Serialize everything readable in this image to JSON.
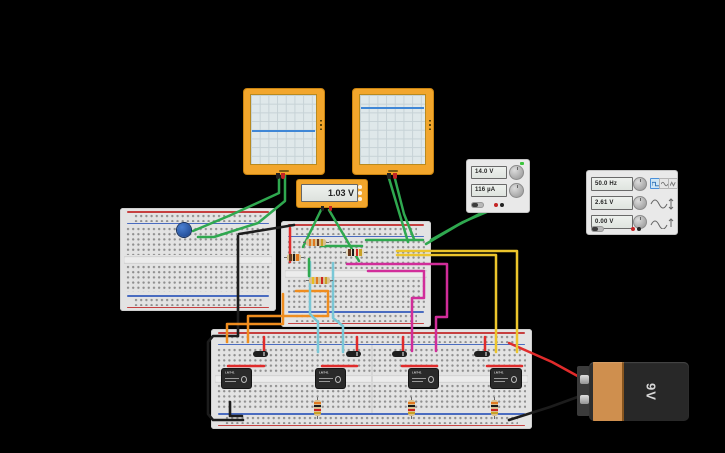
{
  "app": {
    "background_color": "#000000"
  },
  "oscilloscopes": [
    {
      "name": "oscilloscope-1",
      "trace_y_pct": 51,
      "trace_color": "#3f87d6"
    },
    {
      "name": "oscilloscope-2",
      "trace_y_pct": 17,
      "trace_color": "#3f87d6"
    }
  ],
  "multimeter": {
    "reading": "1.03 V"
  },
  "power_supply": {
    "voltage_display": "14.0 V",
    "current_display": "116 µA"
  },
  "function_generator": {
    "frequency_display": "50.0 Hz",
    "amplitude_display": "2.61 V",
    "offset_display": "0.00 V",
    "waveform_icons": [
      "square-wave",
      "sine-wave",
      "triangle-wave"
    ],
    "selected_waveform": "square-wave"
  },
  "battery": {
    "label": "9V"
  },
  "ics": [
    "LM741",
    "LM741",
    "LM741",
    "LM741"
  ],
  "colors": {
    "device_orange": "#f2a62c",
    "wire_green": "#2fa84f",
    "wire_red": "#e02b2b",
    "wire_black": "#1c1c1c",
    "wire_yellow": "#ecc52c",
    "wire_magenta": "#d12d9a",
    "wire_cyan": "#79c7d6",
    "wire_orange": "#ef8d1f"
  }
}
